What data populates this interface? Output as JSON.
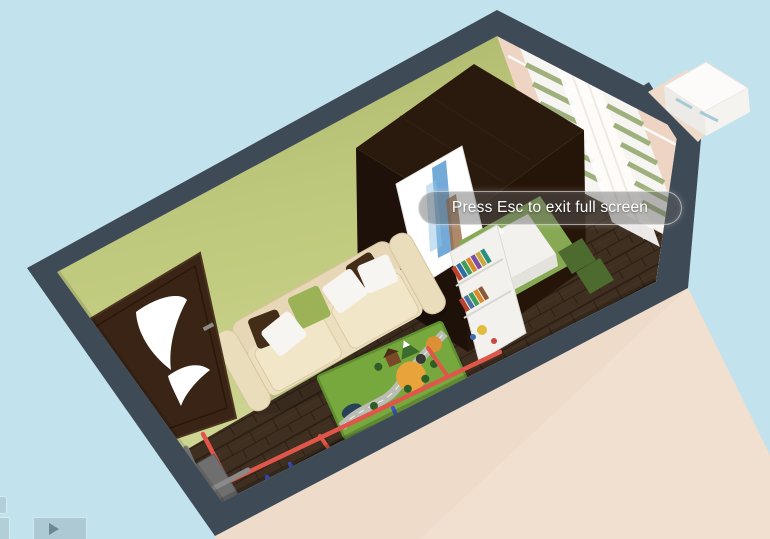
{
  "view": {
    "name": "3d-floorplan-fullscreen-view"
  },
  "notification": {
    "message": "Press Esc to exit full screen"
  },
  "controls": {
    "play_button": {
      "icon": "play-icon"
    },
    "side_tab_count": 2
  },
  "palette": {
    "sky": "#c2e2ee",
    "wall_top": "#3f4a57",
    "exterior_wall": "#efdbca",
    "interior_left_wall": "#b9c372",
    "interior_right_wall": "#eed5c3",
    "floor": "#3f2f20",
    "door": "#3a2416",
    "wardrobe_top": "#2a1a0e",
    "wardrobe_front": "#1d1109",
    "wardrobe_side": "#251408",
    "sofa": "#e7d7b6",
    "sofa_cushion": "#f1e6c8",
    "pillow_white": "#f7f5f1",
    "pillow_brown": "#432d19",
    "pillow_green": "#9cb257",
    "kids_rug": "#76a83d",
    "grass_rug": "#87a954",
    "shelf_white": "#f2f1ed",
    "bench_green": "#4e6b2f",
    "curtain_stripe": "#9eb07c",
    "pipe_red": "#e0564a",
    "pipe_blue": "#3f55cc",
    "pipe_beige": "#c9b79e"
  },
  "book_colors": [
    "#b8432f",
    "#2e6da4",
    "#3f9d58",
    "#d98b2b",
    "#7b4ea0",
    "#c9a83c",
    "#2a8f80",
    "#b8432f",
    "#4a6fa5",
    "#3f9d58",
    "#d98b2b",
    "#8a5a38"
  ],
  "room": {
    "objects": [
      "door",
      "wardrobe",
      "poster",
      "sofa",
      "kids-play-rug",
      "striped-curtains",
      "sheer-curtain",
      "curtain-rod",
      "bookshelf",
      "desk",
      "bench-cushions",
      "grass-rug",
      "heating-pipes",
      "radiator-box",
      "outdoor-cabinet"
    ]
  }
}
